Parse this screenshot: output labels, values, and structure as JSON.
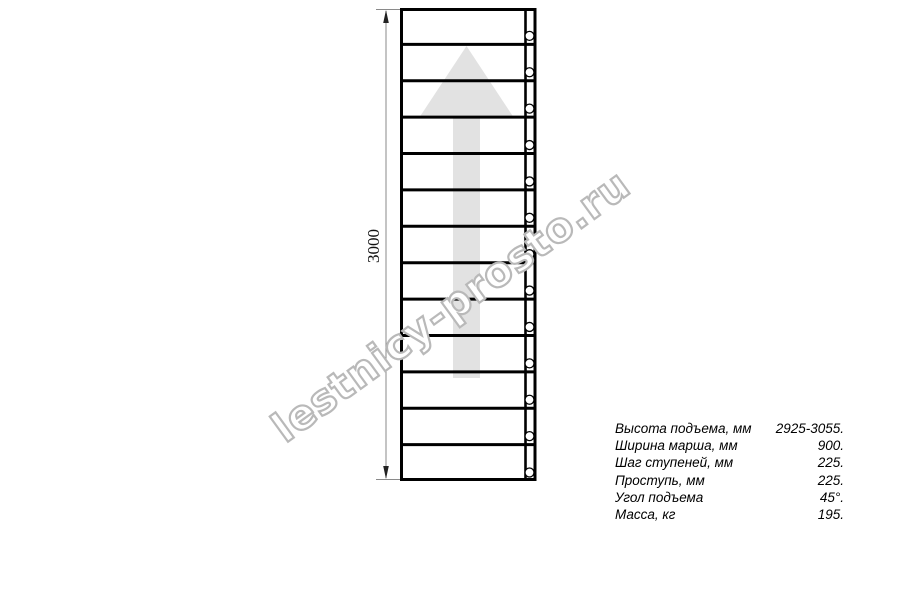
{
  "watermark": {
    "text": "lestnicy-prosto.ru",
    "outline_color": "#b9b9b9"
  },
  "drawing": {
    "type": "staircase-plan-top-view",
    "dimension_label": "3000",
    "tread_count": 13,
    "fastener_count": 13,
    "line_color": "#000000",
    "dim_line_color": "#8a8a8a",
    "arrow_color": "#e2e2e2",
    "direction_arrow": "up-arrow"
  },
  "specs": {
    "rows": [
      {
        "label": "Высота подъема, мм",
        "value": "2925-3055."
      },
      {
        "label": "Ширина марша, мм",
        "value": "900."
      },
      {
        "label": "Шаг ступеней, мм",
        "value": "225."
      },
      {
        "label": "Проступь, мм",
        "value": "225."
      },
      {
        "label": "Угол подъема",
        "value": "45°."
      },
      {
        "label": "Масса, кг",
        "value": "195."
      }
    ]
  }
}
